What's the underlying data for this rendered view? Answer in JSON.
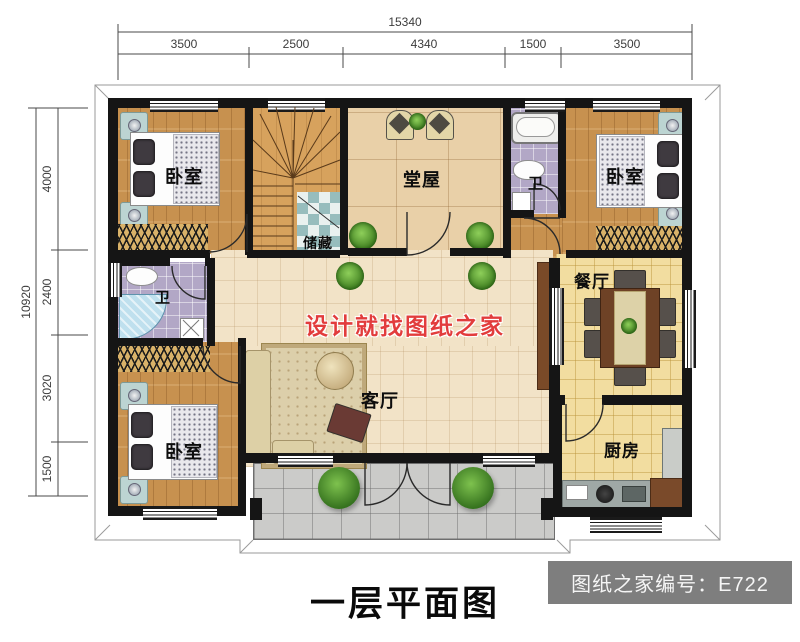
{
  "plan": {
    "title": "一层平面图",
    "badge_text": "图纸之家编号：E722",
    "watermark": "设计就找图纸之家"
  },
  "dimensions": {
    "top": {
      "total": "15340",
      "segments": [
        "3500",
        "2500",
        "4340",
        "1500",
        "3500"
      ]
    },
    "left": {
      "total": "10920",
      "segments": [
        "4000",
        "2400",
        "3020",
        "1500"
      ]
    }
  },
  "rooms": {
    "bedroom_tl": {
      "label": "卧室"
    },
    "bedroom_tr": {
      "label": "卧室"
    },
    "bedroom_bl": {
      "label": "卧室"
    },
    "hall": {
      "label": "堂屋"
    },
    "storage": {
      "label": "储藏"
    },
    "bath_top": {
      "label": "卫"
    },
    "bath_left": {
      "label": "卫"
    },
    "living": {
      "label": "客厅"
    },
    "dining": {
      "label": "餐厅"
    },
    "kitchen": {
      "label": "厨房"
    }
  },
  "colors": {
    "wall": "#151515",
    "wood_floor": "#c7914f",
    "hall_floor": "#e9d0a8",
    "bath_tile": "#b2a7c6",
    "kitchen_tile": "#f2dda0",
    "porch_tile": "#cbcbc9",
    "watermark_red": "#e23c3c",
    "badge_bg": "#7e7e7e"
  }
}
